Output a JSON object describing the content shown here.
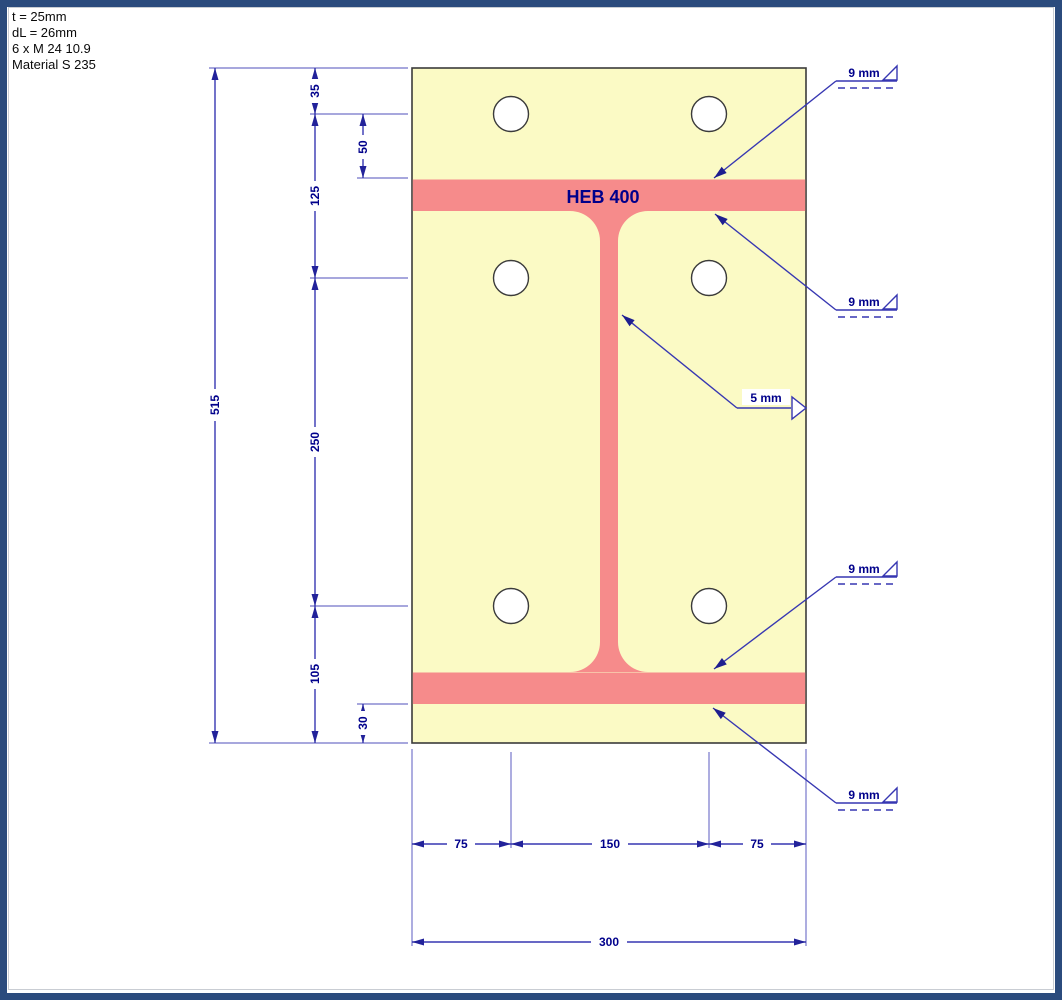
{
  "info": {
    "line1": "t = 25mm",
    "line2": "dL = 26mm",
    "line3": "6 x M 24 10.9",
    "line4": "Material S 235"
  },
  "beam": {
    "label": "HEB 400"
  },
  "dims": {
    "total_height": "515",
    "edge_to_row1": "35",
    "row1_to_flange": "50",
    "row1_to_row2": "125",
    "row2_to_row3": "250",
    "row3_to_edge": "105",
    "flange_to_edge": "30",
    "col_left": "75",
    "col_mid": "150",
    "col_right": "75",
    "total_width": "300"
  },
  "welds": {
    "top_flange_outer": "9 mm",
    "top_flange_inner": "9 mm",
    "web": "5 mm",
    "bottom_flange_inner": "9 mm",
    "bottom_flange_outer": "9 mm"
  },
  "colors": {
    "frame": "#2B4B7D",
    "plate_fill": "#FBFAC5",
    "beam_fill": "#F68B8B",
    "outline": "#3B3B3B",
    "dimension_line": "#3737B2",
    "extension_line": "#8A8AD2",
    "dimension_text": "#00008B",
    "annotation_text": "#00008B"
  }
}
